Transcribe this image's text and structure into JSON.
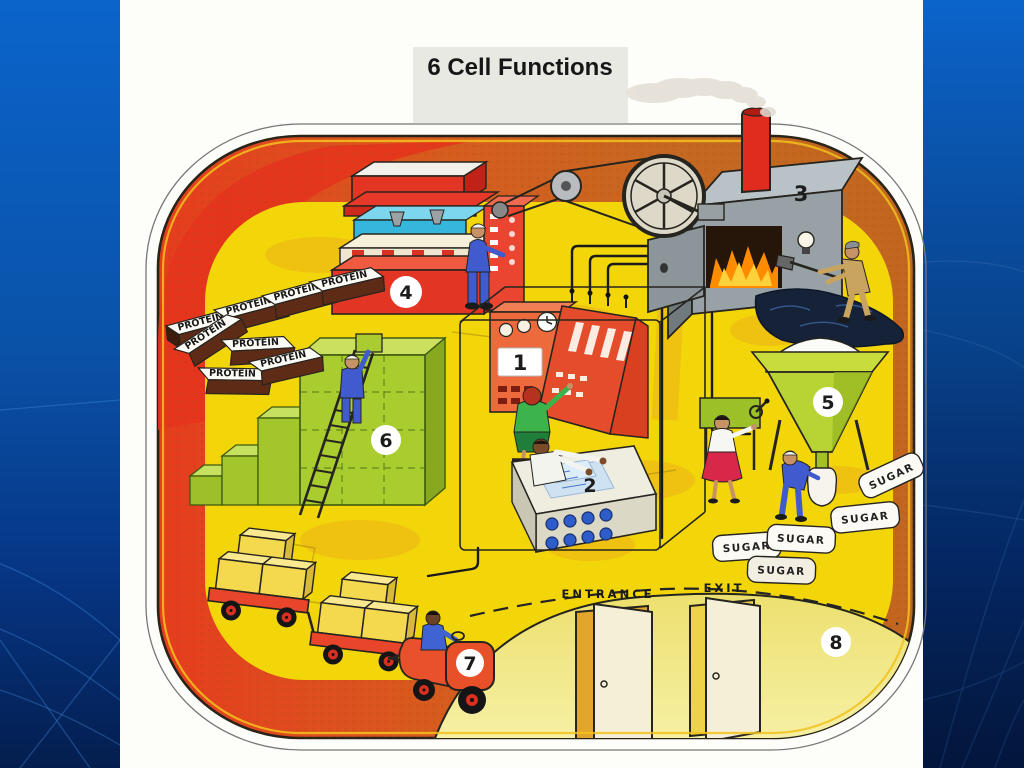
{
  "slide": {
    "title": "6 Cell Functions"
  },
  "diagram": {
    "numbers": [
      "1",
      "2",
      "3",
      "4",
      "5",
      "6",
      "7",
      "8"
    ],
    "labels": {
      "protein": "PROTEIN",
      "sugar": "SUGAR",
      "entrance": "ENTRANCE",
      "exit": "EXIT"
    }
  },
  "colors": {
    "title_band": "#e9e9e4",
    "floor_yellow": "#f3d60a",
    "machine_red": "#e23524",
    "water_blue": "#35b6dd",
    "crate_green": "#a9cc2f",
    "hopper_green": "#b7d434",
    "furnace_gray": "#97a1a6",
    "chimney_red": "#e02c1e",
    "wall_pale_yellow": "#f3e88e"
  }
}
